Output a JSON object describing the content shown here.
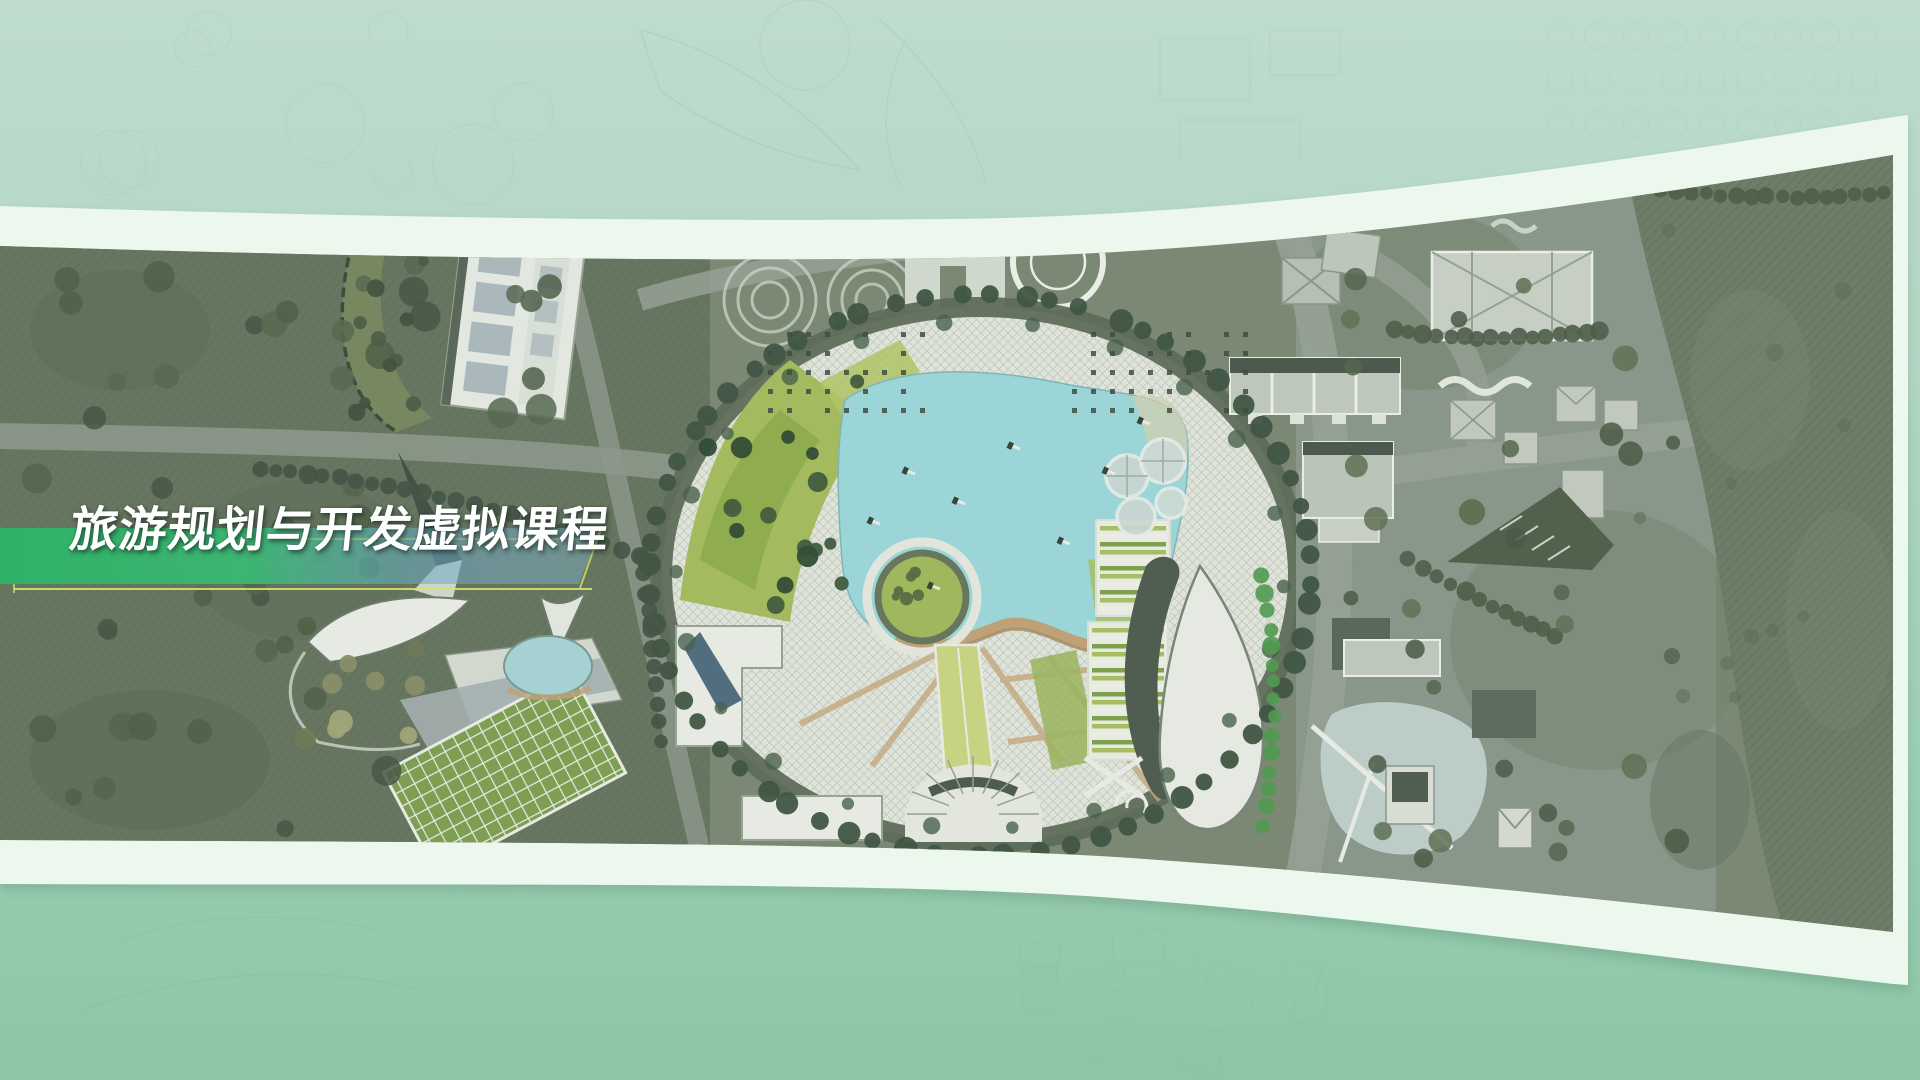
{
  "slide": {
    "title": "旅游规划与开发虚拟课程"
  },
  "colors": {
    "background_top": "#bfdccd",
    "background_bottom": "#8cc6a6",
    "ribbon_white": "#ecf7ee",
    "banner_green": "#2eb268",
    "banner_teal_fade": "#7fb4cc",
    "banner_underline_yellow": "#d9e26b",
    "title_text": "#ffffff",
    "map_terrain": "#7b8874",
    "map_terrain_dark": "#66755f",
    "map_lake": "#9edade",
    "map_lawn": "#a6bf5d",
    "map_plaza": "#e7eae2",
    "map_tree_dark": "#3d5340",
    "map_boardwalk_tan": "#c4a379"
  }
}
